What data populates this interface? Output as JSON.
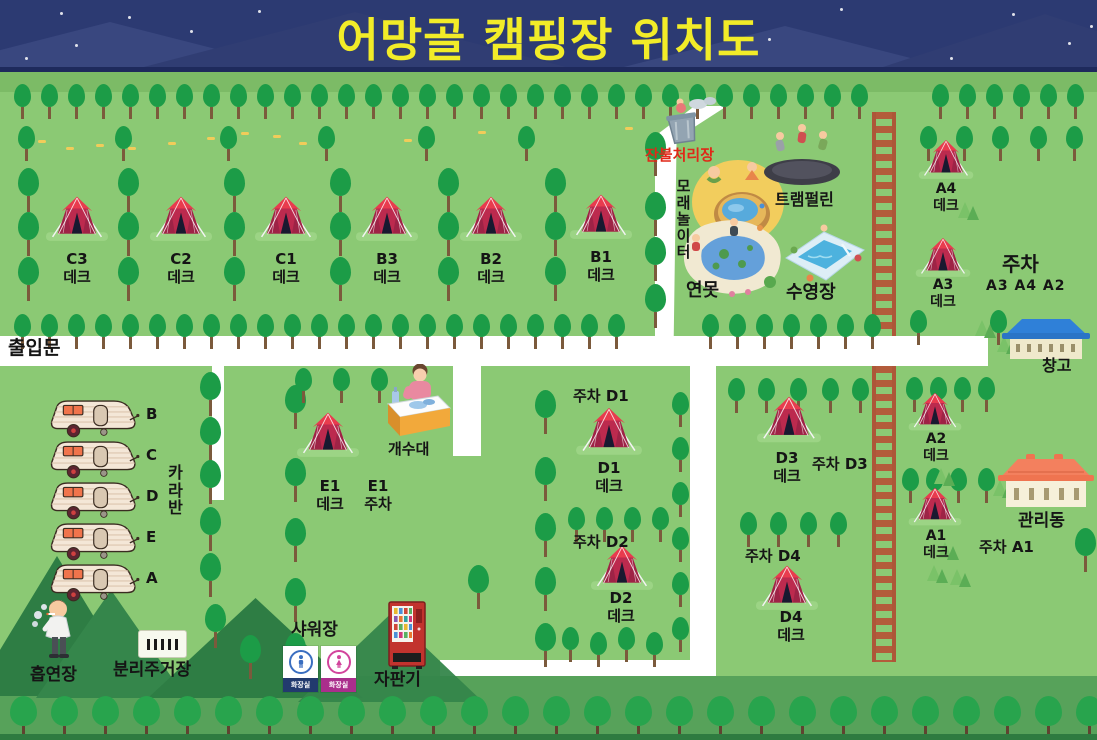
{
  "title": "어망골 캠핑장 위치도",
  "entrance": "출입문",
  "deck_word": "데크",
  "parking_word": "주차",
  "tents": {
    "c3": "C3",
    "c2": "C2",
    "c1": "C1",
    "b3": "B3",
    "b2": "B2",
    "b1": "B1",
    "a4": "A4",
    "a3": "A3",
    "a2": "A2",
    "a1": "A1",
    "d1": "D1",
    "d2": "D2",
    "d3": "D3",
    "d4": "D4",
    "e1": "E1"
  },
  "parking": {
    "area_a": {
      "title": "주차",
      "row": "A3 A4 A2"
    },
    "d1": "주차 D1",
    "d2": "주차 D2",
    "d3": "주차 D3",
    "d4": "주차 D4",
    "a1": "주차 A1"
  },
  "caravan": {
    "label": "카라반",
    "units": [
      "B",
      "C",
      "D",
      "E",
      "A"
    ]
  },
  "facilities": {
    "ember_disposal": "잔불처리장",
    "sand_playground": "모래놀이터",
    "trampoline": "트램펄린",
    "pond": "연못",
    "pool": "수영장",
    "sink": "개수대",
    "warehouse": "창고",
    "admin_building": "관리동",
    "smoking_area": "흡연장",
    "recycling": "분리주거장",
    "shower": "샤워장",
    "toilet": "화장실",
    "vending": "자판기"
  },
  "colors": {
    "sky": "#2c3a72",
    "title": "#f2ec28",
    "field": "#8bc974",
    "road": "#ffffff",
    "tent": "#bc2a4e",
    "fence": "#b35c3b",
    "ember_label": "#e02818"
  }
}
